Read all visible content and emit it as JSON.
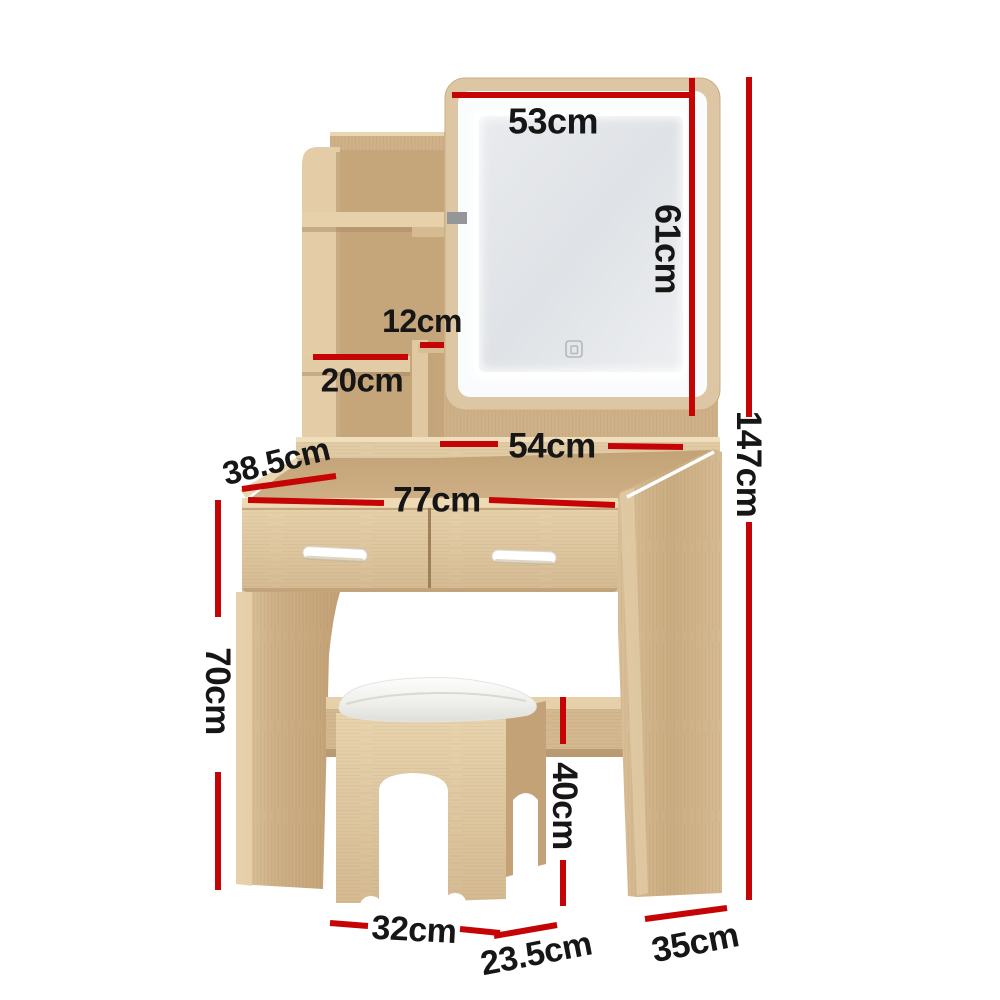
{
  "image": {
    "type": "product-dimension-diagram",
    "subject": "dressing table with LED mirror, shelves, two drawers and cushioned stool",
    "background": "#ffffff"
  },
  "colors": {
    "measure_line": "#c50505",
    "measure_text": "#161616",
    "wood_light": "#e3cda6",
    "wood_mid": "#d3b78e",
    "wood_dark": "#c3a277",
    "cushion_white": "#f2f2ef",
    "mirror_face": "#e7e9ec",
    "led_glow": "#ffffff",
    "bracket_gray": "#95969a",
    "handle_white": "#ffffff"
  },
  "measurements": {
    "mirror_width": "53cm",
    "mirror_height": "61cm",
    "total_height": "147cm",
    "cubby_width": "12cm",
    "shelf_width": "20cm",
    "shelf_span": "54cm",
    "desk_depth": "38.5cm",
    "desk_width": "77cm",
    "leg_height": "70cm",
    "stool_height": "40cm",
    "stool_width": "32cm",
    "stool_depth": "23.5cm",
    "base_depth": "35cm"
  }
}
